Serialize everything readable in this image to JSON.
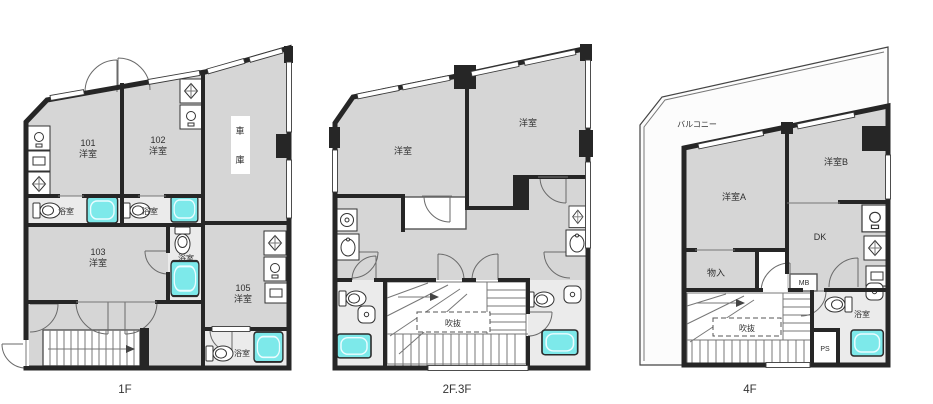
{
  "colors": {
    "background": "#ffffff",
    "wall": "#262626",
    "room_fill": "#d6d6d6",
    "bath_fill": "#ebebeb",
    "tub_fill": "#7de9ea",
    "text": "#2f2f2f"
  },
  "floors": {
    "f1": {
      "caption": "1F",
      "labels": {
        "r101_no": "101",
        "r101_type": "洋室",
        "r102_no": "102",
        "r102_type": "洋室",
        "r103_no": "103",
        "r103_type": "洋室",
        "r105_no": "105",
        "r105_type": "洋室",
        "garage_v1": "車",
        "garage_v2": "庫",
        "bath_a": "浴室",
        "bath_b": "浴室",
        "bath_c": "浴室",
        "bath_d": "浴室"
      }
    },
    "f23": {
      "caption": "2F.3F",
      "labels": {
        "room_left": "洋室",
        "room_right": "洋室",
        "void": "吹抜"
      }
    },
    "f4": {
      "caption": "4F",
      "labels": {
        "balcony": "バルコニー",
        "room_a": "洋室A",
        "room_b": "洋室B",
        "dk": "DK",
        "closet": "物入",
        "meter_box": "MB",
        "void": "吹抜",
        "pipe_space": "PS",
        "bath": "浴室"
      }
    }
  },
  "icons": {
    "bathtub": "cyan rounded rectangle",
    "toilet": "ellipse bowl with tank",
    "door-swing": "quarter arc",
    "stairs": "striped treads with direction arrow",
    "sink": "box with circle",
    "stove": "box with diamond",
    "washer": "box with drum circle"
  }
}
